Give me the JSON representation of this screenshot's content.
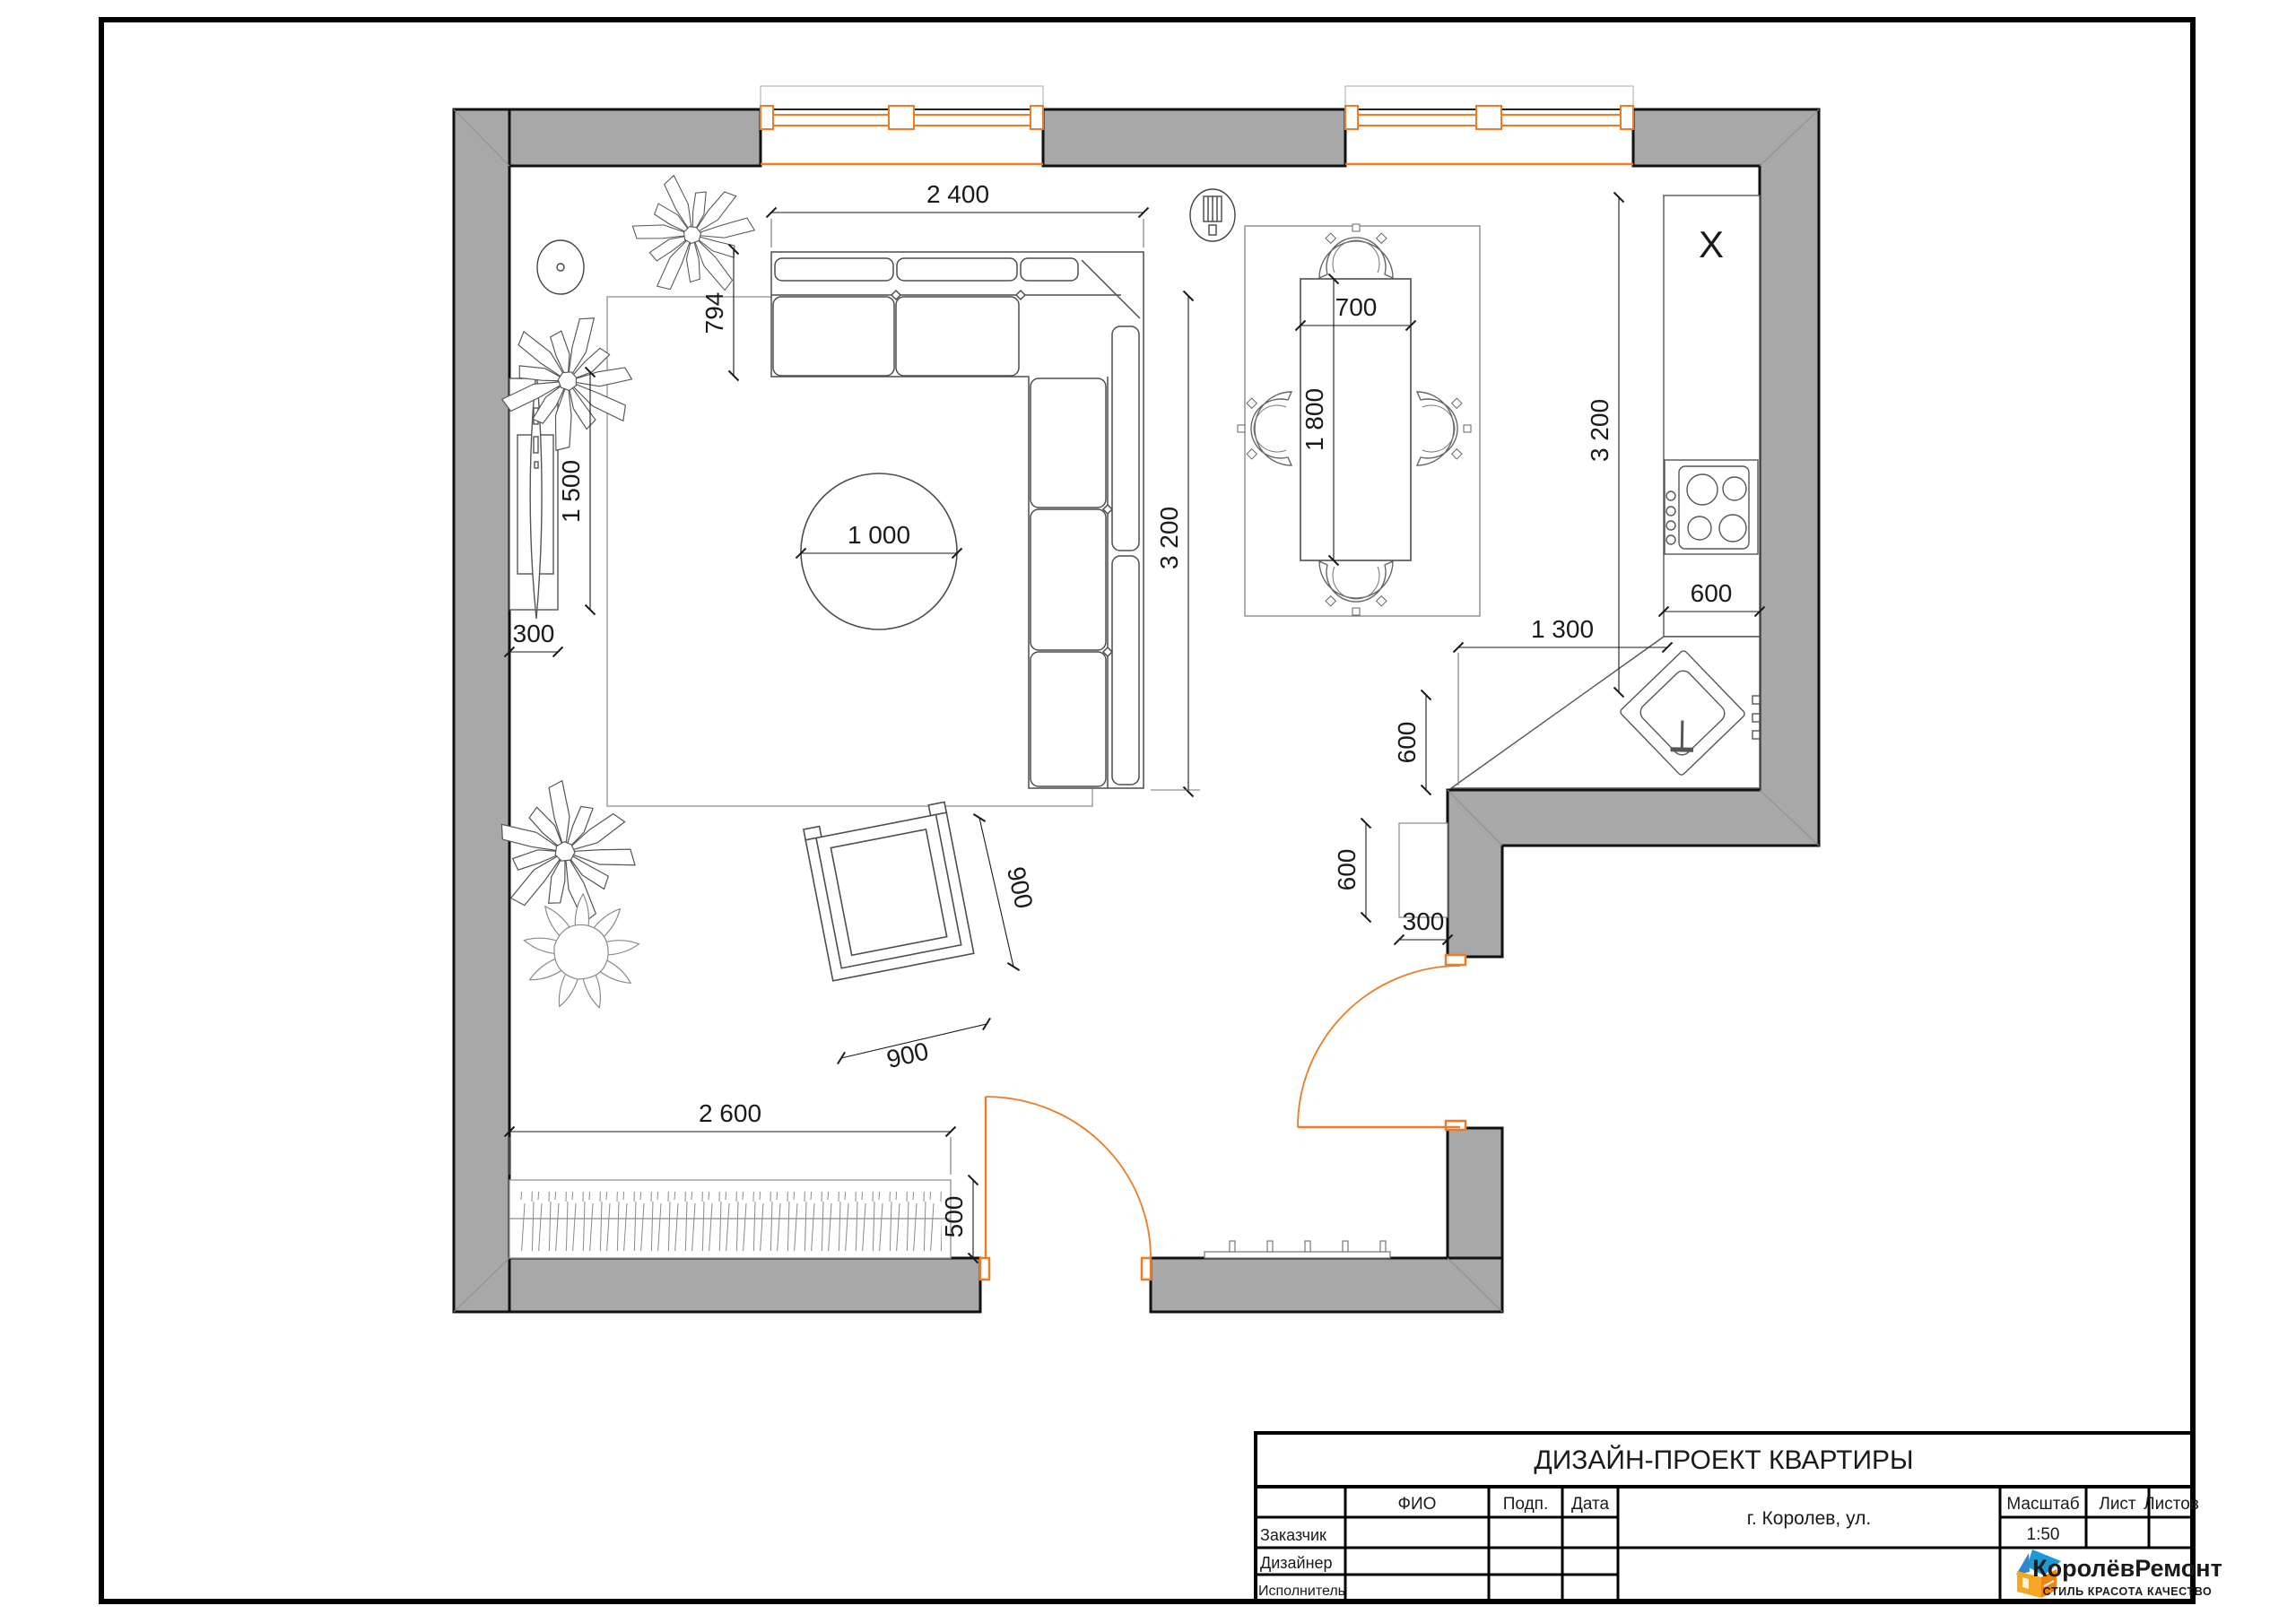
{
  "plan": {
    "dims": {
      "sofa_width": "2 400",
      "sofa_depth": "794",
      "tv_length": "1 500",
      "tv_depth": "300",
      "round_table": "1 000",
      "living_depth": "3 200",
      "dining_table_width": "700",
      "dining_table_length": "1 800",
      "kitchen_length": "3 200",
      "counter_width": "600",
      "counter_corner": "1 300",
      "sink_offset": "600",
      "hall_cabinet_length": "600",
      "hall_cabinet_depth": "300",
      "armchair_width": "900",
      "armchair_depth": "900",
      "wardrobe_width": "2 600",
      "wardrobe_depth": "500"
    },
    "labels": {
      "counter_mark": "X"
    }
  },
  "title_block": {
    "title": "ДИЗАЙН-ПРОЕКТ КВАРТИРЫ",
    "address": "г. Королев, ул.",
    "col_fio": "ФИО",
    "col_podp": "Подп.",
    "col_data": "Дата",
    "col_scale": "Масштаб",
    "scale_value": "1:50",
    "col_sheet": "Лист",
    "col_sheets": "Листов",
    "row_customer": "Заказчик",
    "row_designer": "Дизайнер",
    "row_executor": "Исполнитель",
    "logo_text": "КоролёвРемонт",
    "logo_subtitle": "СТИЛЬ КРАСОТА КАЧЕСТВО"
  },
  "colors": {
    "wall_fill": "#a8a8a8",
    "accent_orange": "#ec7c26",
    "logo_blue": "#1b9ad6",
    "logo_orange": "#f5820c"
  }
}
